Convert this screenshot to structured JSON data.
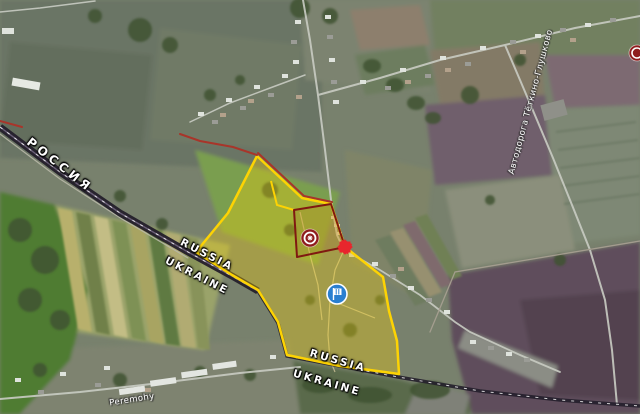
{
  "map": {
    "labels": {
      "country_ru": "РОССИЯ",
      "border_pair_1": {
        "russia": "RUSSIA",
        "ukraine": "UKRAINE"
      },
      "border_pair_2": {
        "russia": "RUSSIA",
        "ukraine": "UKRAINE"
      },
      "road": "Автодорога Тёткино-Глушково",
      "street": "Peremohy"
    },
    "colors": {
      "zone_yellow": "#fdd303",
      "frontline_red": "#a8352a",
      "salient_dark_red": "#801911",
      "border_line": "#241f2b",
      "marker_battle": "#8f1d1d",
      "marker_flag_blue": "#2a7fd0",
      "marker_clash_red": "#e8262d"
    },
    "icons": {
      "battle_icon": "battle-circle",
      "flag_icon": "flag-circle",
      "clash_icon": "clash-burst",
      "battle_icon_edge": "battle-circle"
    }
  }
}
